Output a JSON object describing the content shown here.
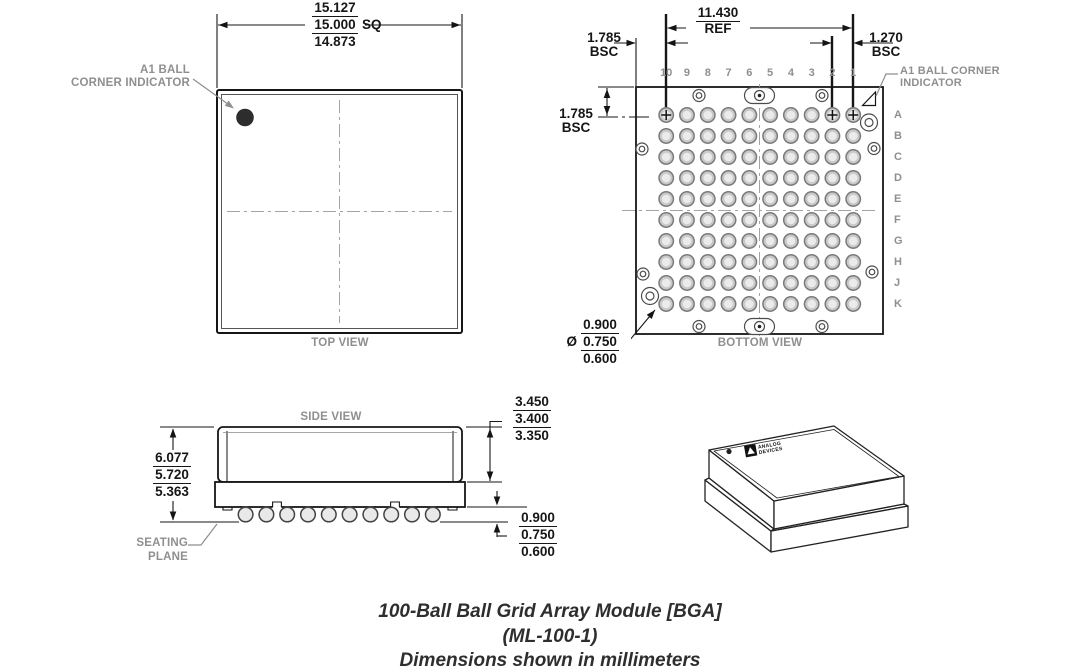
{
  "caption": {
    "line1": "100-Ball Ball Grid Array Module [BGA]",
    "line2": "(ML-100-1)",
    "line3": "Dimensions shown in millimeters"
  },
  "top_view": {
    "label": "TOP VIEW",
    "a1_label_line1": "A1 BALL",
    "a1_label_line2": "CORNER INDICATOR",
    "dim_size": {
      "max": "15.127",
      "nom": "15.000",
      "suffix": "SQ",
      "min": "14.873"
    }
  },
  "bottom_view": {
    "label": "BOTTOM VIEW",
    "a1_label_line1": "A1 BALL CORNER",
    "a1_label_line2": "INDICATOR",
    "columns": [
      "10",
      "9",
      "8",
      "7",
      "6",
      "5",
      "4",
      "3",
      "2",
      "1"
    ],
    "rows": [
      "A",
      "B",
      "C",
      "D",
      "E",
      "F",
      "G",
      "H",
      "J",
      "K"
    ],
    "dim_span": {
      "value": "11.430",
      "qualifier": "REF"
    },
    "dim_edge_top": {
      "value": "1.785",
      "qualifier": "BSC"
    },
    "dim_pitch": {
      "value": "1.270",
      "qualifier": "BSC"
    },
    "dim_edge_left": {
      "value": "1.785",
      "qualifier": "BSC"
    },
    "dim_ball_diameter": {
      "diameter_symbol": "Ø",
      "max": "0.900",
      "nom": "0.750",
      "min": "0.600"
    }
  },
  "side_view": {
    "label": "SIDE VIEW",
    "seating_plane_line1": "SEATING",
    "seating_plane_line2": "PLANE",
    "dim_height": {
      "max": "6.077",
      "nom": "5.720",
      "min": "5.363"
    },
    "dim_lid": {
      "max": "3.450",
      "nom": "3.400",
      "min": "3.350"
    },
    "dim_standoff": {
      "max": "0.900",
      "nom": "0.750",
      "min": "0.600"
    }
  },
  "iso_view": {
    "logo_line1": "ANALOG",
    "logo_line2": "DEVICES"
  },
  "colors": {
    "line": "#161616",
    "label_gray": "#8f8f8f",
    "ball_fill": "#c9c9c9",
    "ball_stroke": "#7a7a7a",
    "a1_dot": "#2d2d2d",
    "centerline": "#a3a3a3"
  }
}
